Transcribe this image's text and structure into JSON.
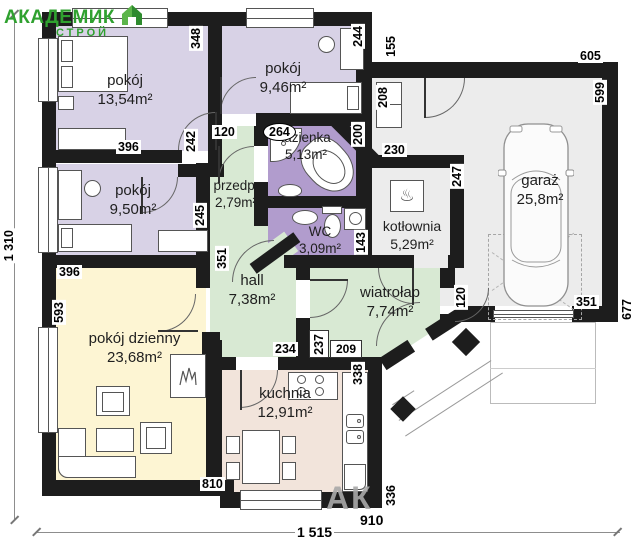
{
  "logo": {
    "line1": "АКАДЕМИК",
    "line2": "СТРОЙ"
  },
  "watermark": "АК",
  "overall_dimensions": {
    "width_label": "1 515",
    "height_label": "1 310"
  },
  "rooms": [
    {
      "id": "room-1",
      "name": "pokój",
      "area": "13,54m²"
    },
    {
      "id": "room-2",
      "name": "pokój",
      "area": "9,46m²"
    },
    {
      "id": "bathroom",
      "name": "łazienka",
      "area": "5,13m²"
    },
    {
      "id": "hallway",
      "name": "przedp.",
      "area": "2,79m²"
    },
    {
      "id": "wc",
      "name": "WC",
      "area": "3,09m²"
    },
    {
      "id": "room-3",
      "name": "pokój",
      "area": "9,50m²"
    },
    {
      "id": "hall",
      "name": "hall",
      "area": "7,38m²"
    },
    {
      "id": "vestibule",
      "name": "wiatrołap",
      "area": "7,74m²"
    },
    {
      "id": "boiler-room",
      "name": "kotłownia",
      "area": "5,29m²"
    },
    {
      "id": "garage",
      "name": "garaż",
      "area": "25,8m²"
    },
    {
      "id": "living-room",
      "name": "pokój dzienny",
      "area": "23,68m²"
    },
    {
      "id": "kitchen",
      "name": "kuchnia",
      "area": "12,91m²"
    }
  ],
  "wall_dimensions": [
    "348",
    "244",
    "155",
    "605",
    "599",
    "396",
    "120",
    "242",
    "264",
    "200",
    "208",
    "230",
    "247",
    "245",
    "351",
    "143",
    "396",
    "593",
    "234",
    "237",
    "209",
    "338",
    "120",
    "351",
    "677",
    "810",
    "336",
    "910"
  ],
  "icons": {
    "boiler": "♨"
  },
  "colors": {
    "wall": "#1d1d1d",
    "bedroom_fill": "#d8d2e6",
    "bath_fill": "#b19ccd",
    "corridor_fill": "#d8e9d3",
    "utility_fill": "#ececec",
    "living_fill": "#fdf5d3",
    "kitchen_fill": "#f2e4db",
    "logo_green": "#2fa12f"
  }
}
